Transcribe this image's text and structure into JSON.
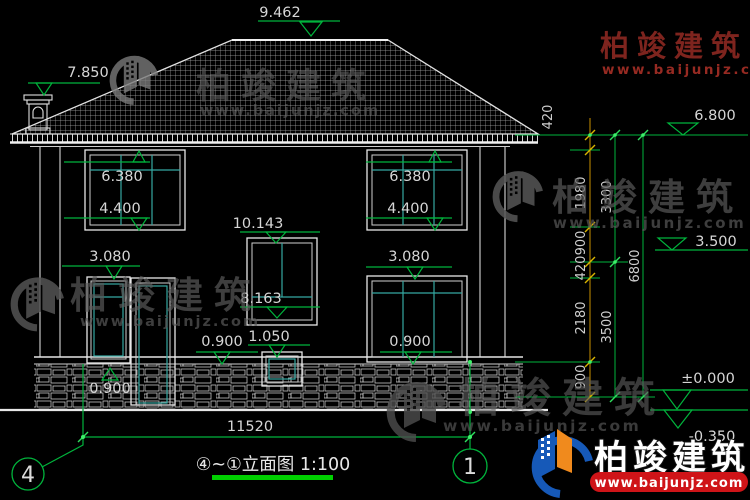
{
  "title": {
    "text": "④~①立面图 1:100"
  },
  "axes": {
    "left": "4",
    "right": "1"
  },
  "annotations": {
    "ridge": "9.462",
    "chimney": "7.850",
    "w2l": {
      "head": "6.380",
      "sill": "4.400"
    },
    "w2r": {
      "head": "6.380",
      "sill": "4.400"
    },
    "stair": {
      "head": "10.143",
      "sill": "8.163"
    },
    "small": {
      "head": "1.050"
    },
    "w1l": {
      "head": "3.080",
      "sill": "0.900"
    },
    "w1r": {
      "head": "3.080",
      "sill": "0.900"
    },
    "door": {
      "sill": "0.900"
    }
  },
  "right_dims": {
    "inner": [
      "420",
      "1980",
      "900",
      "420",
      "2180",
      "900"
    ],
    "mid": [
      "3300",
      "3500"
    ],
    "outer": [
      "6800"
    ],
    "levels": {
      "eave": "6.800",
      "floor": "3.500",
      "zero": "±0.000",
      "minus": "-0.350"
    }
  },
  "bottom_dim": {
    "span": "11520"
  },
  "watermark": {
    "brand": "柏竣建筑",
    "url": "www.baijunjz.com"
  },
  "corner_logo": {
    "brand": "柏竣建筑",
    "url": "www.baijunjz.com"
  },
  "colors": {
    "cad_green": "#00b43c",
    "cad_teal": "#35a8a2",
    "dim_orange": "#c89000",
    "banner_red": "#cf1418",
    "logo_blue": "#1659b8",
    "logo_orange": "#f08a1d"
  }
}
